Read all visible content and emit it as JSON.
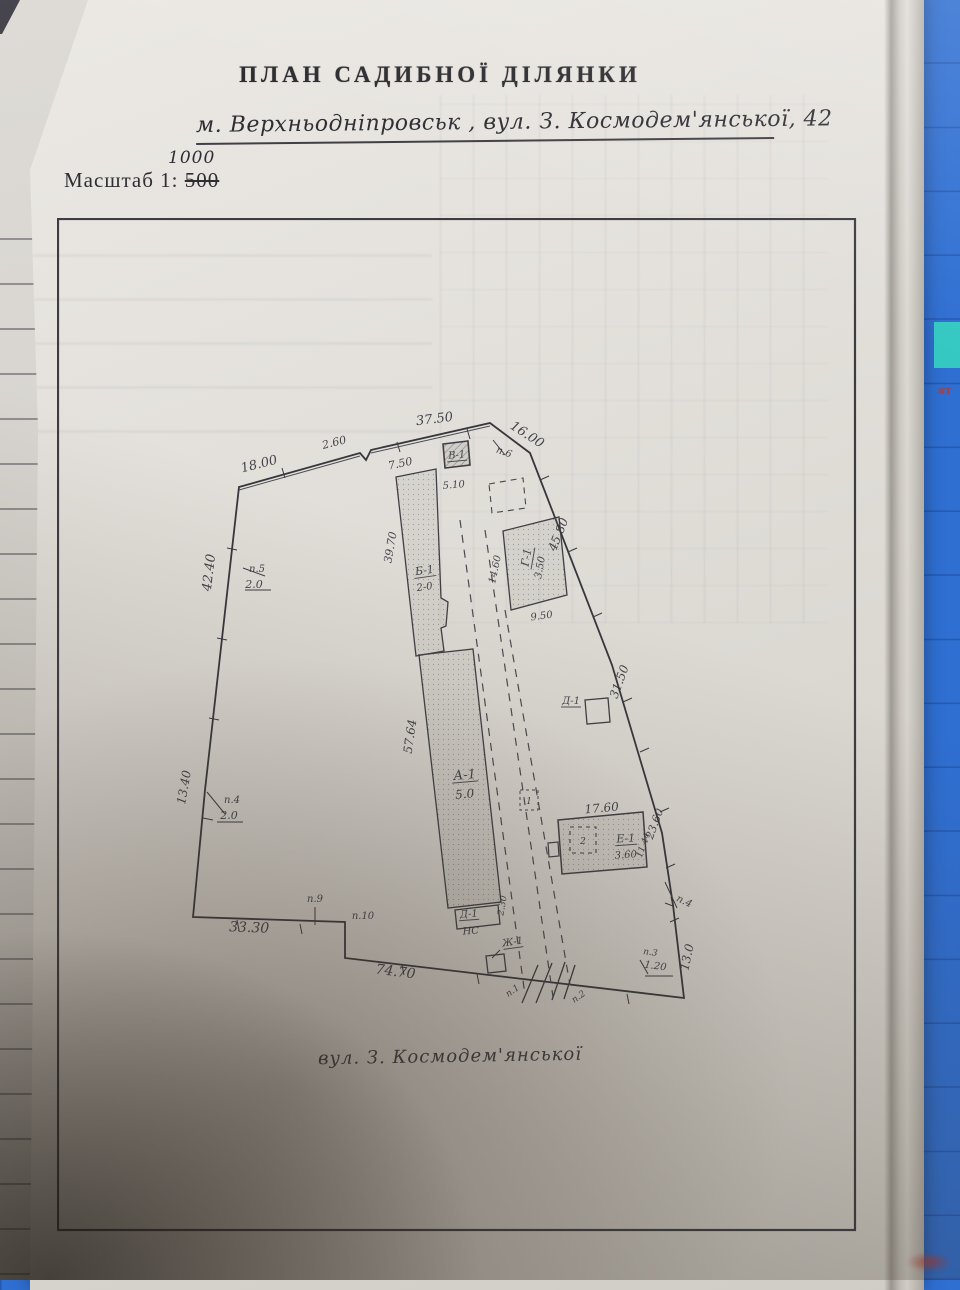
{
  "surface": {
    "mat_color": "#2f6fd2",
    "accent_teal": "#35c8c2",
    "side_text": "ят"
  },
  "header": {
    "title": "ПЛАН САДИБНОЇ ДІЛЯНКИ",
    "address": "м. Верхньодніпровськ , вул. З. Космодем'янської, 42",
    "scale_label": "Масштаб 1:",
    "scale_old": "500",
    "scale_new": "1000"
  },
  "footer": {
    "street": "вул. З. Космодем'янської"
  },
  "plan": {
    "labels": [
      {
        "t": "18.00",
        "x": 203,
        "y": 250,
        "r": -14,
        "fs": 13,
        "n": "dimension-label"
      },
      {
        "t": "2.60",
        "x": 278,
        "y": 228,
        "r": -14,
        "fs": 11,
        "n": "dimension-label"
      },
      {
        "t": "37.50",
        "x": 378,
        "y": 205,
        "r": -7,
        "fs": 13,
        "n": "dimension-label"
      },
      {
        "t": "16.00",
        "x": 468,
        "y": 220,
        "r": 33,
        "fs": 13,
        "n": "dimension-label"
      },
      {
        "t": "п.6",
        "x": 446,
        "y": 237,
        "r": 20,
        "fs": 10,
        "n": "point-marker"
      },
      {
        "t": "7.50",
        "x": 344,
        "y": 249,
        "r": -12,
        "fs": 11,
        "n": "dimension-label"
      },
      {
        "t": "В-1",
        "x": 400,
        "y": 240,
        "r": -5,
        "fs": 10,
        "u": 1,
        "n": "building-label"
      },
      {
        "t": "5.10",
        "x": 397,
        "y": 270,
        "r": -5,
        "fs": 10,
        "n": "dimension-label"
      },
      {
        "t": "42.40",
        "x": 156,
        "y": 355,
        "r": -83,
        "fs": 13,
        "n": "dimension-label"
      },
      {
        "t": "п.5",
        "x": 200,
        "y": 354,
        "r": 0,
        "fs": 10,
        "n": "point-marker"
      },
      {
        "t": "2.0",
        "x": 197,
        "y": 370,
        "r": 0,
        "fs": 11,
        "n": "dimension-label"
      },
      {
        "t": "13.40",
        "x": 131,
        "y": 570,
        "r": -80,
        "fs": 12,
        "n": "dimension-label"
      },
      {
        "t": "п.4",
        "x": 175,
        "y": 585,
        "r": 0,
        "fs": 10,
        "n": "point-marker"
      },
      {
        "t": "2.0",
        "x": 172,
        "y": 601,
        "r": 0,
        "fs": 11,
        "n": "dimension-label"
      },
      {
        "t": "33.30",
        "x": 192,
        "y": 714,
        "r": 2,
        "fs": 14,
        "n": "dimension-label"
      },
      {
        "t": "п.9",
        "x": 258,
        "y": 684,
        "r": 0,
        "fs": 10,
        "n": "point-marker"
      },
      {
        "t": "п.10",
        "x": 306,
        "y": 701,
        "r": 0,
        "fs": 10,
        "n": "point-marker"
      },
      {
        "t": "74.70",
        "x": 338,
        "y": 758,
        "r": 7,
        "fs": 14,
        "n": "dimension-label"
      },
      {
        "t": "Ж-1",
        "x": 456,
        "y": 727,
        "r": -8,
        "fs": 10,
        "u": 1,
        "n": "building-label"
      },
      {
        "t": "п.1",
        "x": 457,
        "y": 775,
        "r": -35,
        "fs": 9,
        "n": "point-marker"
      },
      {
        "t": "п.2",
        "x": 523,
        "y": 781,
        "r": -35,
        "fs": 9,
        "n": "point-marker"
      },
      {
        "t": "п.3",
        "x": 593,
        "y": 737,
        "r": 8,
        "fs": 9,
        "n": "point-marker"
      },
      {
        "t": "1.20",
        "x": 598,
        "y": 751,
        "r": 8,
        "fs": 10,
        "n": "dimension-label"
      },
      {
        "t": "13.0",
        "x": 634,
        "y": 740,
        "r": -78,
        "fs": 12,
        "n": "dimension-label"
      },
      {
        "t": "п.4",
        "x": 626,
        "y": 686,
        "r": 25,
        "fs": 10,
        "n": "point-marker"
      },
      {
        "t": "23.60",
        "x": 601,
        "y": 607,
        "r": -70,
        "fs": 11,
        "n": "dimension-label"
      },
      {
        "t": "11.44",
        "x": 589,
        "y": 628,
        "r": -70,
        "fs": 9,
        "n": "dimension-label"
      },
      {
        "t": "17.60",
        "x": 545,
        "y": 594,
        "r": -5,
        "fs": 12,
        "n": "dimension-label"
      },
      {
        "t": "Е-1",
        "x": 569,
        "y": 624,
        "r": -4,
        "fs": 11,
        "u": 1,
        "n": "building-label"
      },
      {
        "t": "3.60",
        "x": 569,
        "y": 640,
        "r": -4,
        "fs": 10,
        "n": "dimension-label"
      },
      {
        "t": "2",
        "x": 526,
        "y": 626,
        "r": 0,
        "fs": 9,
        "n": "structure-number"
      },
      {
        "t": "31.50",
        "x": 566,
        "y": 465,
        "r": -70,
        "fs": 12,
        "n": "dimension-label"
      },
      {
        "t": "45.80",
        "x": 505,
        "y": 318,
        "r": -68,
        "fs": 12,
        "n": "dimension-label"
      },
      {
        "t": "14.60",
        "x": 441,
        "y": 352,
        "r": -78,
        "fs": 10,
        "n": "dimension-label"
      },
      {
        "t": "Г-1",
        "x": 473,
        "y": 340,
        "r": -80,
        "fs": 11,
        "u": 1,
        "n": "building-label"
      },
      {
        "t": "3.50",
        "x": 486,
        "y": 350,
        "r": -80,
        "fs": 10,
        "n": "dimension-label"
      },
      {
        "t": "9.50",
        "x": 485,
        "y": 401,
        "r": -8,
        "fs": 10,
        "n": "dimension-label"
      },
      {
        "t": "39.70",
        "x": 337,
        "y": 330,
        "r": -80,
        "fs": 11,
        "n": "dimension-label"
      },
      {
        "t": "Б-1",
        "x": 368,
        "y": 356,
        "r": -8,
        "fs": 11,
        "u": 1,
        "n": "building-label"
      },
      {
        "t": "2-0",
        "x": 368,
        "y": 372,
        "r": -8,
        "fs": 10,
        "n": "dimension-label"
      },
      {
        "t": "57.64",
        "x": 357,
        "y": 519,
        "r": -82,
        "fs": 12,
        "n": "dimension-label"
      },
      {
        "t": "А-1",
        "x": 408,
        "y": 561,
        "r": -5,
        "fs": 13,
        "u": 1,
        "n": "building-label"
      },
      {
        "t": "5.0",
        "x": 408,
        "y": 580,
        "r": -5,
        "fs": 12,
        "n": "dimension-label"
      },
      {
        "t": "Д-1",
        "x": 412,
        "y": 699,
        "r": -4,
        "fs": 10,
        "u": 1,
        "n": "building-label"
      },
      {
        "t": "НС",
        "x": 414,
        "y": 716,
        "r": -4,
        "fs": 10,
        "n": "building-value"
      },
      {
        "t": "2.30",
        "x": 448,
        "y": 688,
        "r": -80,
        "fs": 9,
        "n": "dimension-label"
      },
      {
        "t": "Д-1",
        "x": 514,
        "y": 486,
        "r": 0,
        "fs": 10,
        "u": 1,
        "n": "building-label"
      },
      {
        "t": "1",
        "x": 472,
        "y": 586,
        "r": 0,
        "fs": 9,
        "n": "structure-number"
      }
    ]
  }
}
